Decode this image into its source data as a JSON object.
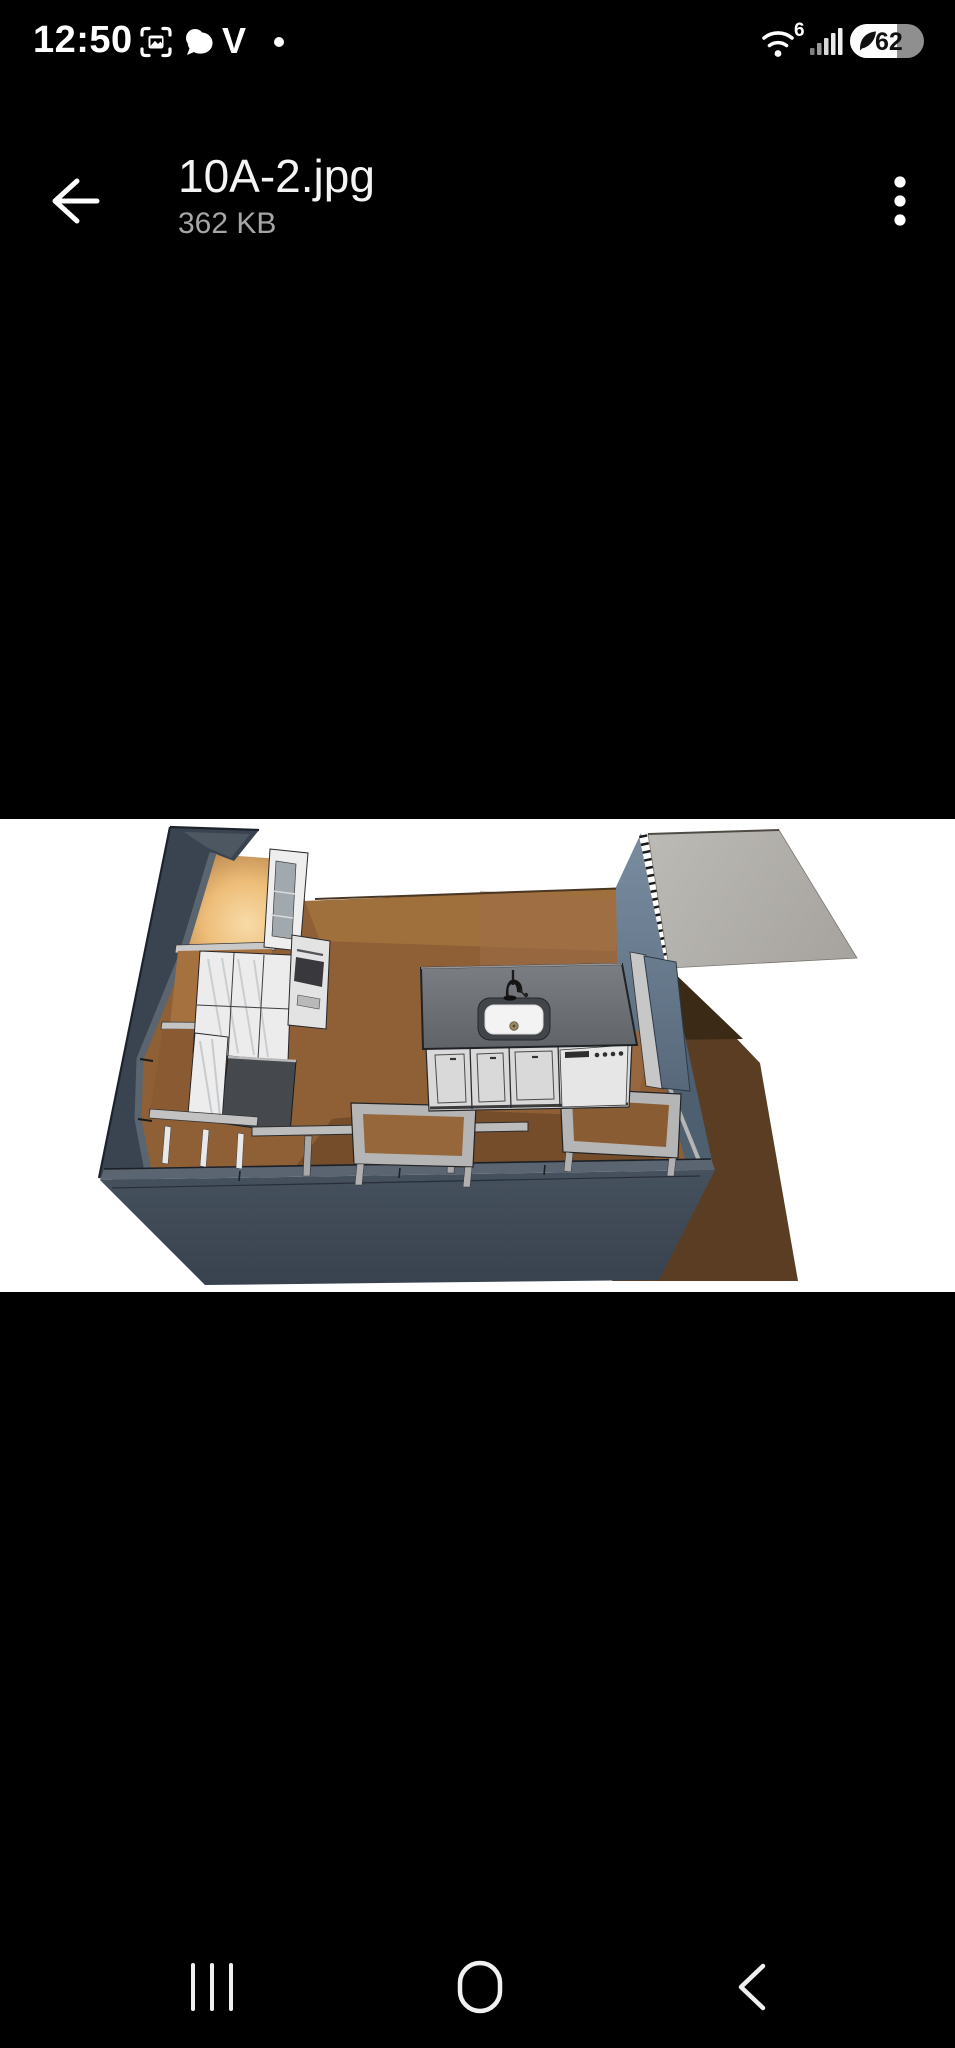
{
  "status_bar": {
    "time": "12:50",
    "wifi_generation": "6",
    "battery_percent": "62",
    "left_icons": [
      "screenshot-icon",
      "messages-icon",
      "v-app-icon",
      "notification-dot"
    ],
    "right_icons": [
      "wifi-icon",
      "signal-icon",
      "battery-icon"
    ]
  },
  "app_bar": {
    "title": "10A-2.jpg",
    "subtitle": "362 KB"
  },
  "viewer": {
    "description": "3D isometric kitchen floor-plan render on white background",
    "colors": {
      "background": "#ffffff",
      "wall": "#3a4450",
      "floor": "#8f5f36",
      "glow": "#f6d098",
      "cabinet": "#ececec",
      "island_top": "#6e7277",
      "blue_wall": "#5d7086",
      "gray_panel": "#b2b0ab"
    }
  },
  "nav_bar": {
    "buttons": [
      "recents",
      "home",
      "back"
    ]
  }
}
